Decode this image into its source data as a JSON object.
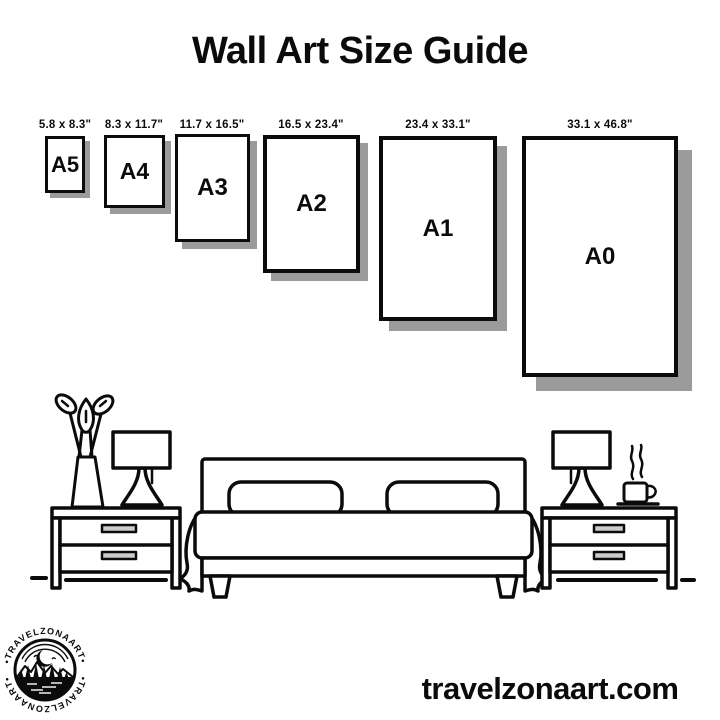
{
  "title": "Wall Art Size Guide",
  "size_guide": {
    "sizes": [
      {
        "label": "A5",
        "inches": "5.8 x 8.3\""
      },
      {
        "label": "A4",
        "inches": "8.3 x 11.7\""
      },
      {
        "label": "A3",
        "inches": "11.7 x 16.5\""
      },
      {
        "label": "A2",
        "inches": "16.5 x 23.4\""
      },
      {
        "label": "A1",
        "inches": "23.4 x 33.1\""
      },
      {
        "label": "A0",
        "inches": "33.1 x 46.8\""
      }
    ]
  },
  "logo": {
    "text_top": "•TRAVELZONAART•",
    "text_bottom": "•TRAVELZONAART•"
  },
  "footer": {
    "website": "travelzonaart.com"
  },
  "colors": {
    "ink": "#0b0b0b",
    "shadow": "#9b9b9b",
    "background": "#ffffff"
  }
}
